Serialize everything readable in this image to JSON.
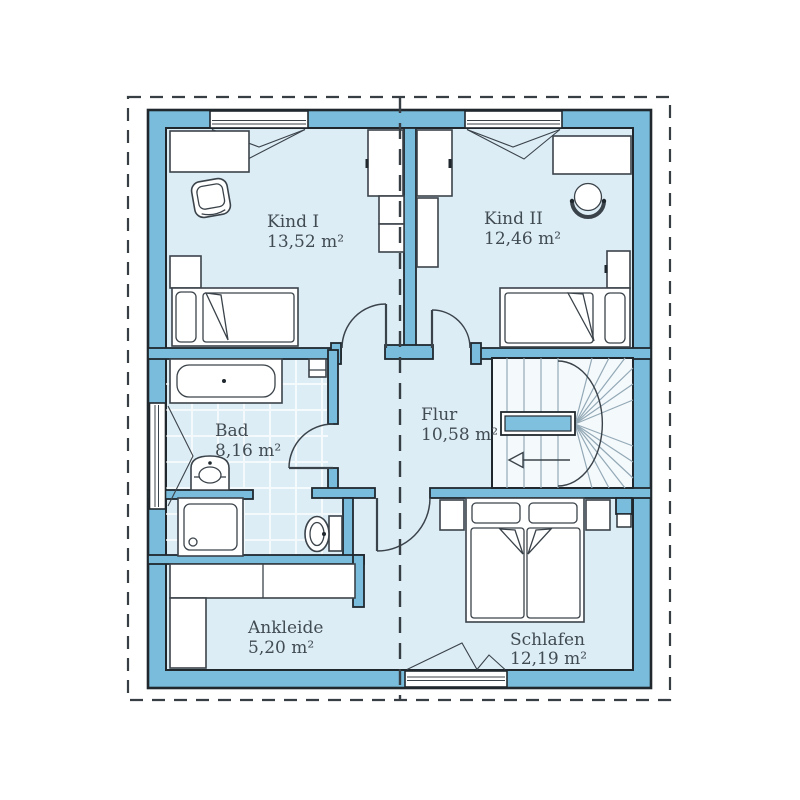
{
  "plan": {
    "type": "floor-plan",
    "rooms": [
      {
        "id": "kind1",
        "name": "Kind I",
        "area": "13,52 m²"
      },
      {
        "id": "kind2",
        "name": "Kind II",
        "area": "12,46 m²"
      },
      {
        "id": "bad",
        "name": "Bad",
        "area": "8,16 m²"
      },
      {
        "id": "flur",
        "name": "Flur",
        "area": "10,58 m²"
      },
      {
        "id": "ankleide",
        "name": "Ankleide",
        "area": "5,20 m²"
      },
      {
        "id": "schlafen",
        "name": "Schlafen",
        "area": "12,19 m²"
      }
    ],
    "colors": {
      "wall": "#79bcdc",
      "floor": "#ddedf6",
      "stair_floor": "#f4f9fc",
      "outline": "#20282e",
      "furniture": "#ffffff",
      "text": "#414b52",
      "boundary_dash": "#373f45"
    }
  }
}
